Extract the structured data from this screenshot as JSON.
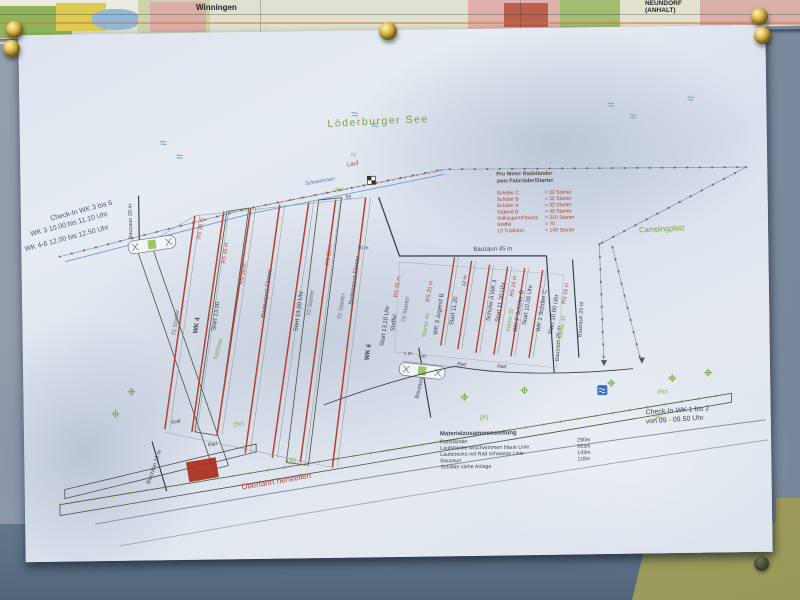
{
  "colors": {
    "ink": "#3f4550",
    "red": "#b5412f",
    "green": "#76a73d",
    "blue": "#4579b5",
    "paper": "#e3e9f1",
    "board": "#8493a6",
    "olive": "#a4a362",
    "brass": "#c9a93c"
  },
  "map_strip": {
    "label_left": "Winningen",
    "label_right_1": "NEUNDORF",
    "label_right_2": "(ANHALT)"
  },
  "plan": {
    "lake_label": "Löderburger See",
    "wave_symbol": "≈",
    "campsite_label": "Campingplatz",
    "checkin_afternoon": {
      "line1": "Check-In WK 3 bis 6",
      "line2": "WK 3    10.00 bis 11.10 Uhr",
      "line3": "WK 4-6    12.00 bis 12.50 Uhr"
    },
    "checkin_morning": {
      "line1": "Check-In WK 1 bis 2",
      "line2": "von 09 - 09.50 Uhr"
    },
    "course": {
      "lauf": "Lauf",
      "schwimmen": "Schwimmen",
      "so": "(So)",
      "fifty": "50",
      "marker": "IV",
      "rad": "Rad",
      "a": "(A)",
      "so_gras": "So/Gras",
      "ueberfahrt": "Überfahrt herstellen"
    },
    "rack_legend": {
      "title1": "Pro Meter Radständer",
      "title2": "zwei Fahrräder/Starter",
      "rows": [
        {
          "label": "Schüler C",
          "value": "= 32 Starter"
        },
        {
          "label": "Schüler B",
          "value": "= 32 Starter"
        },
        {
          "label": "Schüler A",
          "value": "= 32 Starter"
        },
        {
          "label": "Jugend B",
          "value": "= 40 Starter"
        },
        {
          "label": "Volkssport/Fitness",
          "value": "= 210 Starter"
        },
        {
          "label": "Staffel",
          "value": "= 70"
        },
        {
          "label": "13 Triathlon",
          "value": "= 140 Starter"
        }
      ]
    },
    "material_legend": {
      "title": "Materialzusammenstellung",
      "rows": [
        {
          "label": "Radständer",
          "value": "290m"
        },
        {
          "label": "Laufstrecke w/schwimmen blaue Linie",
          "value": "263m"
        },
        {
          "label": "Laufstrecke mit Rad schwarze Linie",
          "value": "143m"
        },
        {
          "label": "Bauzaun",
          "value": "118m"
        },
        {
          "label": "Schilder siehe Anlage",
          "value": ""
        }
      ]
    },
    "afternoon": {
      "starter": "70 Starter",
      "wk4": "WK 4",
      "start_1300": "Start 13.00",
      "rs35": "RS 35 m",
      "start_1320": "Start 13.20 Uhr",
      "breitensport": "Breitensport-Fitness",
      "wk6": "WK 6",
      "start_1310": "Start 13.10 Uhr",
      "staffel": "Staffel"
    },
    "morning": {
      "starter40": "Starter 40",
      "rs20": "RS 20 m",
      "wk3_jugend": "WK 3 Jugend B",
      "start_1120": "Start 11.20",
      "twelve_m": "12 m",
      "schueler_a": "Schüler A WK 3",
      "start_1120_uhr": "Start 11.20 Uhr",
      "starter32": "Starter 32",
      "rs16": "RS 16 m",
      "wk2_schueler_b": "WK 2 Schüler B",
      "start_1030": "Start 10.30 Uhr",
      "wk1_schueler_c": "WK 1 Schüler C",
      "start_1000": "Start 10.00 Uhr"
    },
    "bauzaun": {
      "b20_left": "Bauzaun 20 m",
      "b45": "Bauzaun 45 m",
      "b40": "Bauzaun 40 m",
      "b25": "Bauzaun 25 m",
      "b20_right": "Bauzaun 20 m",
      "b10": "Bauzaun 10 m"
    },
    "dims": {
      "seven_m": "7 m",
      "ten_m": "10 m"
    }
  }
}
